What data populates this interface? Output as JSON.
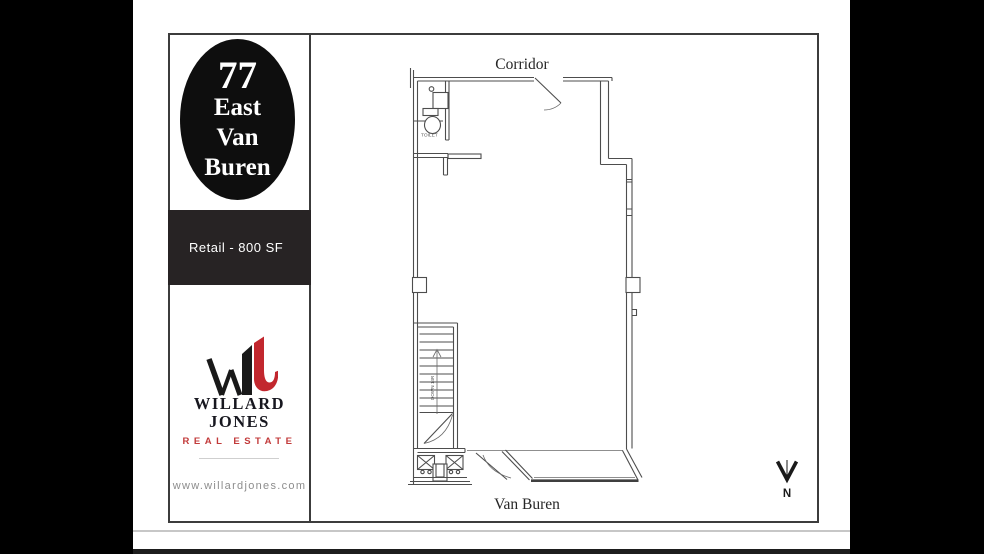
{
  "brand": {
    "oval_lines": [
      "77",
      "East",
      "Van",
      "Buren"
    ],
    "unit_label": "Retail - 800 SF",
    "logo_name_line1": "WILLARD",
    "logo_name_line2": "JONES",
    "logo_subtitle": "REAL ESTATE",
    "website": "www.willardjones.com"
  },
  "plan": {
    "corridor_label": "Corridor",
    "street_label": "Van Buren",
    "toilet_label": "TOILET",
    "stair_label": "DOWN 14R",
    "north_label": "N"
  },
  "colors": {
    "accent_red": "#c2272e",
    "band_black": "#272324",
    "ink_navy": "#17171f"
  }
}
